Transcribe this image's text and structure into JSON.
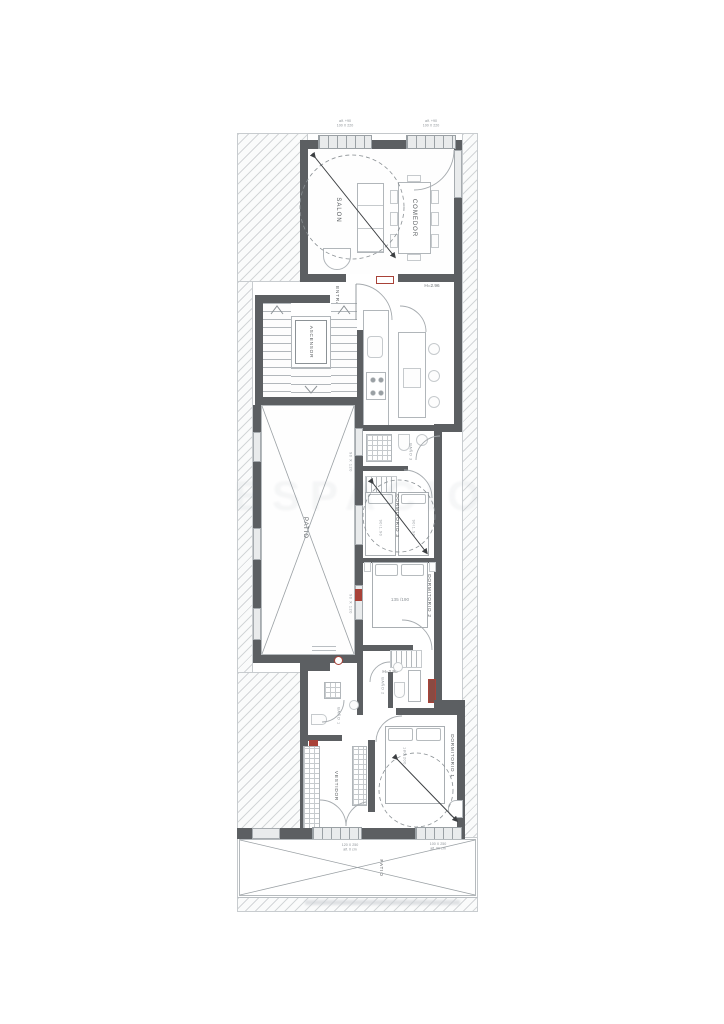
{
  "plan": {
    "rooms": {
      "salon": "SALON",
      "comedor": "COMEDOR",
      "entrada": "ENTRADA",
      "ascensor": "ASCENSOR",
      "patio": "PATIO",
      "bano3": "BAÑO 3",
      "dormitorio3": "DORMITORIO 3",
      "dormitorio2": "DORMITORIO 2",
      "bano2": "BAÑO 2",
      "bano1": "BAÑO 1",
      "vestidor": "VESTIDOR",
      "dormitorio1": "DORMITORIO 1",
      "patio_bottom": "PATIO"
    },
    "annotations": {
      "height_entry": "H=2.96",
      "height_stairs": "H=2.98",
      "bed3_left": "90/1.90",
      "bed3_right": "90/1.90",
      "bed2": "135 /190",
      "bed1": "180/200",
      "window_top_1_sill": "alf. +90",
      "window_top_1_size": "100 X 220",
      "window_top_2_sill": "alf. +90",
      "window_top_2_size": "100 X 220",
      "window_bottom_1_size": "120 X 250",
      "window_bottom_1_sill": "alf. 0 cm",
      "window_bottom_2_size": "100 X 250",
      "window_bottom_2_sill": "alf. 90 cm",
      "patio_window_1": "90 X 120",
      "patio_window_2": "90 X 120"
    },
    "watermark": "ESPACIO",
    "colors": {
      "wall": "#5c5f62",
      "accent_red": "#a84238",
      "line": "#9aa0a4"
    }
  }
}
